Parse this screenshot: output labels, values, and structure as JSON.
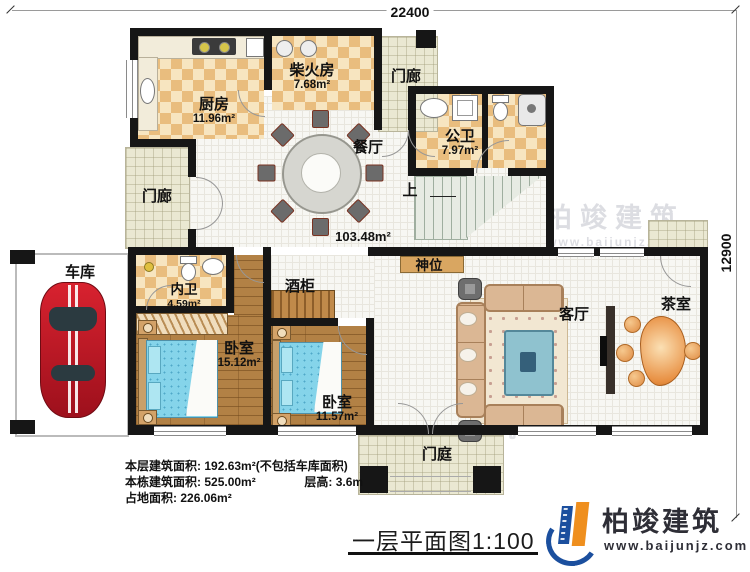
{
  "dimensions": {
    "top": "22400",
    "right": "12900"
  },
  "rooms": {
    "kitchen": {
      "label": "厨房",
      "area": "11.96m²"
    },
    "firewood": {
      "label": "柴火房",
      "area": "7.68m²"
    },
    "porch_top": {
      "label": "门廊"
    },
    "porch_left": {
      "label": "门廊"
    },
    "public_bath": {
      "label": "公卫",
      "area": "7.97m²"
    },
    "dining": {
      "label": "餐厅"
    },
    "stairs_up": {
      "label": "上"
    },
    "hall_area": "103.48m²",
    "shrine": {
      "label": "神位"
    },
    "wine_cabinet": {
      "label": "酒柜"
    },
    "garage": {
      "label": "车库"
    },
    "inner_bath": {
      "label": "内卫",
      "area": "4.59m²"
    },
    "bedroom_master": {
      "label": "卧室",
      "area": "15.12m²"
    },
    "bedroom_second": {
      "label": "卧室",
      "area": "11.57m²"
    },
    "living": {
      "label": "客厅"
    },
    "tea": {
      "label": "茶室"
    },
    "entrance": {
      "label": "门庭"
    }
  },
  "info": {
    "line1_label": "本层建筑面积:",
    "line1_value": "192.63m²(不包括车库面积)",
    "line2_label": "本栋建筑面积:",
    "line2_value": "525.00m²",
    "line2b_label": "层高:",
    "line2b_value": "3.6m",
    "line3_label": "占地面积:",
    "line3_value": "226.06m²"
  },
  "title": "一层平面图1:100",
  "brand": {
    "name": "柏竣建筑",
    "url": "www.baijunjz.com"
  },
  "watermark": {
    "name": "柏竣建筑",
    "url": "www.baijunjz.com"
  },
  "colors": {
    "wall": "#161616",
    "checker_tile": "#e9bd7e",
    "wood": "#b28145",
    "bed": "#85d4ea",
    "accent_blue": "#1b4f9e",
    "accent_orange": "#ef8f1e",
    "car": "#c8131f"
  }
}
